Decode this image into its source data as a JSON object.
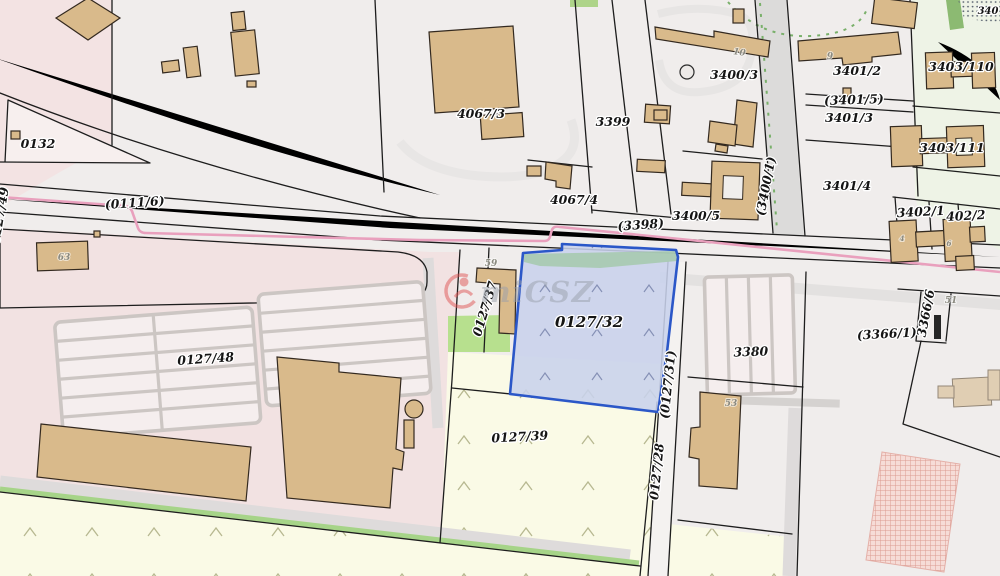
{
  "map": {
    "watermark": {
      "text": "miCSZ",
      "logo": "red-swirl-person-logo"
    },
    "selected_parcel": {
      "id": "0127/32",
      "border_color": "#2b57c8",
      "fill_color": "#c8d2ec"
    },
    "labels": {
      "p0132": "0132",
      "r0111_6": "(0111/6)",
      "p0127_49": "0127/49",
      "p0127_48": "0127/48",
      "p4067_3": "4067/3",
      "p4067_4": "4067/4",
      "p3399": "3399",
      "r3398": "(3398)",
      "p3400_3": "3400/3",
      "p3400_5": "3400/5",
      "r3400_1": "(3400/1)",
      "p3401_2": "3401/2",
      "r3401_5": "(3401/5)",
      "p3401_3": "3401/3",
      "p3401_4": "3401/4",
      "p3403_110": "3403/110",
      "p3403_111": "3403/111",
      "p3402_1": "3402/1",
      "p3402_2": "402/2",
      "p0127_37": "0127/37",
      "p0127_32": "0127/32",
      "r0127_31": "(0127/31)",
      "p0127_28": "0127/28",
      "p0127_39": "0127/39",
      "p3380": "3380",
      "r3366_1": "(3366/1)",
      "p3366_6": "3366/6",
      "corner_partial": "340"
    },
    "building_numbers": {
      "b63": "63",
      "b59": "59",
      "b53": "53",
      "b51": "51",
      "b10": "10",
      "b9": "9",
      "b4": "4",
      "b6": "6"
    },
    "colors": {
      "background_gray": "#f0edec",
      "zone_pink": "#f3e3e3",
      "zone_cream": "#fafae6",
      "zone_green_tint": "#eef3e6",
      "green_area": "#b7e08e",
      "road_gray": "#dcdbda",
      "utility_line_pink": "#e9a0bd",
      "building_fill": "#d9ba8b",
      "selection_border": "#2b57c8",
      "selection_fill": "#c8d2ec",
      "hatch_pink": "#dc9b92",
      "boundary_black": "#1d1d1d"
    }
  }
}
